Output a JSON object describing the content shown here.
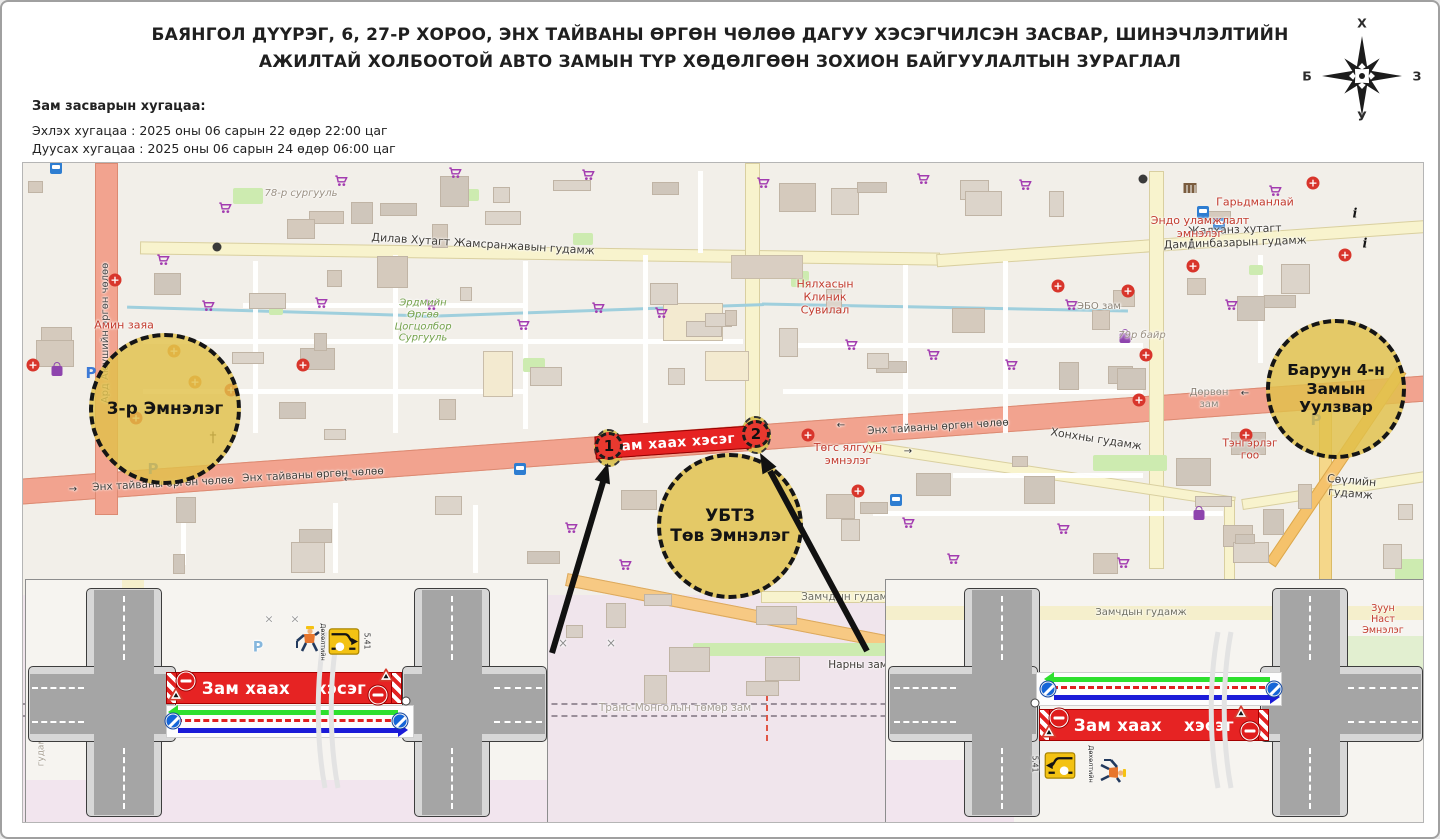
{
  "title": {
    "line1": "БАЯНГОЛ ДҮҮРЭГ, 6, 27-Р ХОРОО, ЭНХ ТАЙВАНЫ ӨРГӨН ЧӨЛӨӨ ДАГУУ ХЭСЭГЧИЛСЭН ЗАСВАР, ШИНЭЧЛЭЛТИЙН",
    "line2": "АЖИЛТАЙ ХОЛБООТОЙ АВТО ЗАМЫН ТҮР ХӨДӨЛГӨӨН ЗОХИОН БАЙГУУЛАЛТЫН ЗУРАГЛАЛ"
  },
  "schedule": {
    "heading": "Зам засварын хугацаа:",
    "line1": "Эхлэх хугацаа : 2025 оны 06 сарын 22 өдөр 22:00 цаг",
    "line2": "Дуусах хугацаа : 2025 оны 06 сарын 24 өдөр 06:00 цаг"
  },
  "compass": {
    "n": "Х",
    "e": "З",
    "s": "У",
    "w": "Б"
  },
  "map": {
    "closure_banner_text": "Зам хаах хэсэг",
    "marker1": "1",
    "marker2": "2",
    "circles_text": [
      "3-р Эмнэлэг",
      "УБТЗ\nТөв Эмнэлэг",
      "Баруун 4-н\nЗамын\nУулзвар"
    ],
    "labels": [
      {
        "t": "Ард Аюушийн өргөн чөлөө",
        "x": 83,
        "y": 170,
        "r": -90,
        "c": "#4a4a4a",
        "s": 10
      },
      {
        "t": "78-р сургууль",
        "x": 278,
        "y": 31,
        "c": "#9b9184",
        "s": 10,
        "i": 1
      },
      {
        "t": "Дилав Хутагт Жамсранжавын гудамж",
        "x": 460,
        "y": 82,
        "r": 3.5,
        "c": "#3f3c37",
        "s": 11
      },
      {
        "t": "Жалханз хутагт Дамдинбазарын гудамж",
        "x": 1212,
        "y": 74,
        "r": -2,
        "c": "#3f3c37",
        "s": 11
      },
      {
        "t": "Нялхасын\nКлиник\nСувилал",
        "x": 802,
        "y": 135,
        "c": "#c23b2e",
        "s": 11
      },
      {
        "t": "Эндо уламжлалт\nэмнэлэг",
        "x": 1177,
        "y": 65,
        "c": "#c23b2e",
        "s": 11
      },
      {
        "t": "Гарьдманлай",
        "x": 1232,
        "y": 40,
        "c": "#c23b2e",
        "s": 11
      },
      {
        "t": "ЭБО зам",
        "x": 1076,
        "y": 144,
        "c": "#8d8579",
        "s": 10
      },
      {
        "t": "79р байр",
        "x": 1119,
        "y": 173,
        "c": "#9b9184",
        "s": 10,
        "i": 1
      },
      {
        "t": "Амин заяа",
        "x": 101,
        "y": 163,
        "c": "#c23b2e",
        "s": 11
      },
      {
        "t": "Эрдмийн\nӨргөө\nЦогцолбор\nСургууль",
        "x": 400,
        "y": 158,
        "c": "#74a24c",
        "s": 10,
        "i": 1
      },
      {
        "t": "Энх тайваны өргөн чөлөө",
        "x": 140,
        "y": 321,
        "r": -3,
        "c": "#3f3c37",
        "s": 10.5
      },
      {
        "t": "Энх тайваны өргөн чөлөө",
        "x": 290,
        "y": 312,
        "r": -3,
        "c": "#3f3c37",
        "s": 10.5
      },
      {
        "t": "Энх тайваны өргөн чөлөө",
        "x": 915,
        "y": 264,
        "r": -3.5,
        "c": "#3f3c37",
        "s": 10.5
      },
      {
        "t": "Төгс ялгуун\nэмнэлэг",
        "x": 825,
        "y": 292,
        "c": "#c23b2e",
        "s": 11
      },
      {
        "t": "Хонхны гудамж",
        "x": 1073,
        "y": 277,
        "r": 9,
        "c": "#3f3c37",
        "s": 11
      },
      {
        "t": "Дөрвөн\nзам",
        "x": 1186,
        "y": 236,
        "c": "#8d8579",
        "s": 10
      },
      {
        "t": "Тэнгэрлэг\nгоо",
        "x": 1227,
        "y": 287,
        "c": "#c23b2e",
        "s": 10.5
      },
      {
        "t": "Сөүлийн гудамж",
        "x": 1328,
        "y": 325,
        "r": 5,
        "c": "#3f3c37",
        "s": 11
      },
      {
        "t": "Замчдын гудамж",
        "x": 826,
        "y": 434,
        "c": "#6e6e60",
        "s": 10.5
      },
      {
        "t": "Нарны зам",
        "x": 835,
        "y": 502,
        "c": "#3f3c37",
        "s": 10.5
      },
      {
        "t": "Транс-Монголын төмөр зам",
        "x": 652,
        "y": 545,
        "c": "#a59e94",
        "s": 10.5
      },
      {
        "t": "→",
        "x": 50,
        "y": 327,
        "c": "#333",
        "s": 10
      },
      {
        "t": "←",
        "x": 325,
        "y": 317,
        "c": "#333",
        "s": 10
      },
      {
        "t": "←",
        "x": 818,
        "y": 263,
        "c": "#333",
        "s": 10
      },
      {
        "t": "→",
        "x": 885,
        "y": 289,
        "c": "#333",
        "s": 10
      },
      {
        "t": "←",
        "x": 1222,
        "y": 231,
        "c": "#333",
        "s": 10
      },
      {
        "t": "×",
        "x": 540,
        "y": 480,
        "c": "#8f8f8f",
        "s": 12
      },
      {
        "t": "×",
        "x": 588,
        "y": 480,
        "c": "#8f8f8f",
        "s": 12
      }
    ],
    "icons": [
      {
        "k": "shopping-cart",
        "x": 202,
        "y": 45
      },
      {
        "k": "shopping-cart",
        "x": 318,
        "y": 18
      },
      {
        "k": "shopping-cart",
        "x": 432,
        "y": 10
      },
      {
        "k": "shopping-cart",
        "x": 565,
        "y": 12
      },
      {
        "k": "shopping-cart",
        "x": 740,
        "y": 20
      },
      {
        "k": "shopping-cart",
        "x": 900,
        "y": 16
      },
      {
        "k": "shopping-cart",
        "x": 1002,
        "y": 22
      },
      {
        "k": "shopping-cart",
        "x": 1252,
        "y": 28
      },
      {
        "k": "shopping-cart",
        "x": 140,
        "y": 97
      },
      {
        "k": "shopping-cart",
        "x": 185,
        "y": 143
      },
      {
        "k": "shopping-cart",
        "x": 298,
        "y": 140
      },
      {
        "k": "shopping-cart",
        "x": 408,
        "y": 142
      },
      {
        "k": "shopping-cart",
        "x": 500,
        "y": 162
      },
      {
        "k": "shopping-cart",
        "x": 575,
        "y": 145
      },
      {
        "k": "shopping-cart",
        "x": 638,
        "y": 150
      },
      {
        "k": "shopping-cart",
        "x": 828,
        "y": 182
      },
      {
        "k": "shopping-cart",
        "x": 910,
        "y": 192
      },
      {
        "k": "shopping-cart",
        "x": 988,
        "y": 202
      },
      {
        "k": "shopping-cart",
        "x": 1048,
        "y": 142
      },
      {
        "k": "shopping-cart",
        "x": 1208,
        "y": 142
      },
      {
        "k": "shopping-cart",
        "x": 548,
        "y": 365
      },
      {
        "k": "shopping-cart",
        "x": 602,
        "y": 402
      },
      {
        "k": "shopping-cart",
        "x": 885,
        "y": 360
      },
      {
        "k": "shopping-cart",
        "x": 930,
        "y": 396
      },
      {
        "k": "shopping-cart",
        "x": 1040,
        "y": 366
      },
      {
        "k": "shopping-cart",
        "x": 1100,
        "y": 400
      },
      {
        "k": "hospital-cross",
        "x": 10,
        "y": 202
      },
      {
        "k": "hospital-cross",
        "x": 92,
        "y": 117
      },
      {
        "k": "hospital-cross",
        "x": 208,
        "y": 227
      },
      {
        "k": "hospital-cross",
        "x": 280,
        "y": 202
      },
      {
        "k": "hospital-cross",
        "x": 785,
        "y": 272
      },
      {
        "k": "hospital-cross",
        "x": 835,
        "y": 328
      },
      {
        "k": "hospital-cross",
        "x": 1035,
        "y": 123
      },
      {
        "k": "hospital-cross",
        "x": 1105,
        "y": 128
      },
      {
        "k": "hospital-cross",
        "x": 1123,
        "y": 192
      },
      {
        "k": "hospital-cross",
        "x": 1116,
        "y": 237
      },
      {
        "k": "hospital-cross",
        "x": 1170,
        "y": 103
      },
      {
        "k": "hospital-cross",
        "x": 1290,
        "y": 20
      },
      {
        "k": "hospital-cross",
        "x": 1322,
        "y": 92
      },
      {
        "k": "hospital-cross",
        "x": 1223,
        "y": 272
      },
      {
        "k": "hospital-cross",
        "x": 113,
        "y": 255
      },
      {
        "k": "hospital-cross-orange",
        "x": 151,
        "y": 188
      },
      {
        "k": "hospital-cross-orange",
        "x": 172,
        "y": 219
      },
      {
        "k": "parking",
        "x": 68,
        "y": 210
      },
      {
        "k": "parking",
        "x": 130,
        "y": 306
      },
      {
        "k": "parking",
        "x": 1293,
        "y": 257
      },
      {
        "k": "bus-stop",
        "x": 33,
        "y": 5
      },
      {
        "k": "bus-stop",
        "x": 1180,
        "y": 37
      },
      {
        "k": "bus-stop",
        "x": 1196,
        "y": 37
      },
      {
        "k": "bus-stop",
        "x": 497,
        "y": 270
      },
      {
        "k": "bus-stop",
        "x": 873,
        "y": 289
      },
      {
        "k": "info",
        "x": 1168,
        "y": 82
      },
      {
        "k": "info",
        "x": 1332,
        "y": 51
      },
      {
        "k": "info",
        "x": 1342,
        "y": 81
      },
      {
        "k": "church-cross",
        "x": 190,
        "y": 275
      },
      {
        "k": "traffic-signal",
        "x": 194,
        "y": 84
      },
      {
        "k": "traffic-signal",
        "x": 1120,
        "y": 16
      },
      {
        "k": "shop-bag",
        "x": 34,
        "y": 144
      },
      {
        "k": "shop-bag",
        "x": 1102,
        "y": 97
      },
      {
        "k": "shop-bag",
        "x": 1176,
        "y": 260
      },
      {
        "k": "museum",
        "x": 1167,
        "y": 25
      }
    ]
  },
  "insets": {
    "closure_text": "Зам хаах хэсэг",
    "sign_number": "5.41",
    "small_sign_text": "Дөхөлтийн",
    "left": {
      "bg_labels": [
        {
          "t": "гудамж",
          "x": 104,
          "y": 45,
          "r": -78,
          "s": 8,
          "c": "#a8a093"
        },
        {
          "t": "гудамж",
          "x": 16,
          "y": 168,
          "r": -90,
          "s": 9,
          "c": "#a8a093"
        },
        {
          "t": "P",
          "x": 232,
          "y": 68,
          "s": 14,
          "c": "#86b7dd",
          "b": 1
        },
        {
          "t": "×",
          "x": 243,
          "y": 40,
          "s": 11,
          "c": "#9a9a9a"
        },
        {
          "t": "×",
          "x": 269,
          "y": 40,
          "s": 11,
          "c": "#9a9a9a"
        }
      ]
    },
    "right": {
      "bg_labels": [
        {
          "t": "Замчдын гудамж",
          "x": 255,
          "y": 33,
          "s": 10,
          "c": "#6e6e60"
        },
        {
          "t": "Зуун Наст\nЭмнэлэг",
          "x": 497,
          "y": 40,
          "s": 9.5,
          "c": "#c23b2e"
        },
        {
          "t": "гудамж",
          "x": 120,
          "y": 205,
          "s": 9,
          "c": "#a8a093",
          "i": 1
        }
      ]
    }
  }
}
